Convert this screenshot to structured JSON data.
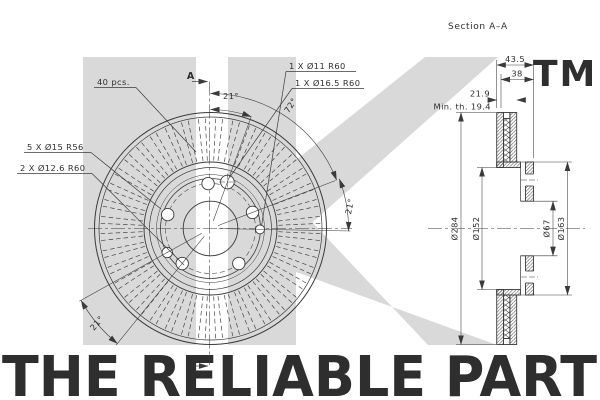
{
  "drawing": {
    "line_color": "#3a3a3a",
    "section_title": "Section A–A",
    "front": {
      "label_vanes": "40 pcs.",
      "label_bolt_holes": "5 X Ø15 R56",
      "label_holes_12_6": "2 X Ø12.6 R60",
      "label_hole_11": "1 X Ø11 R60",
      "label_hole_16_5": "1 X Ø16.5 R60",
      "angle_top": "21°",
      "angle_sweep": "72°",
      "angle_right": "21°",
      "angle_bottom_left": "21°",
      "section_marker_top": "A",
      "section_marker_bottom": "A"
    },
    "section": {
      "dim_total_width": "43.5",
      "dim_hat_width": "38",
      "dim_thickness": "21.9",
      "dim_min_thickness": "Min. th. 19.4",
      "dim_outer_diameter": "Ø284",
      "dim_flange_diameter": "Ø152",
      "dim_bore_diameter": "Ø67",
      "dim_inner_diameter": "Ø163"
    }
  },
  "watermark": {
    "trademark": "TM",
    "tagline": "THE RELIABLE PART",
    "color": "#d9d9d9"
  }
}
